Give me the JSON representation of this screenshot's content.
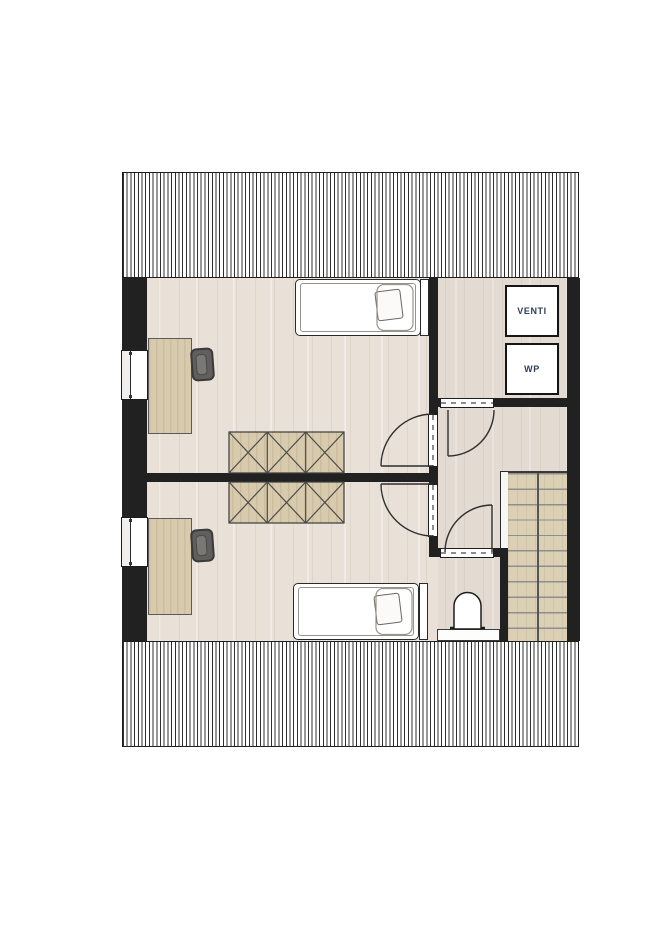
{
  "title": "attic-floor-plan",
  "labels": {
    "venti": "VENTI",
    "wp": "WP"
  },
  "colors": {
    "wall": "#212121",
    "floor": "#e9e1d8",
    "wood": "#d8cbad",
    "wood-streak": "#ccbd9e",
    "stair": "#dbcfb4",
    "stair-line": "#8f8f8f",
    "hatch-line": "#2f2f2f",
    "label-text": "#2e3e5e"
  }
}
